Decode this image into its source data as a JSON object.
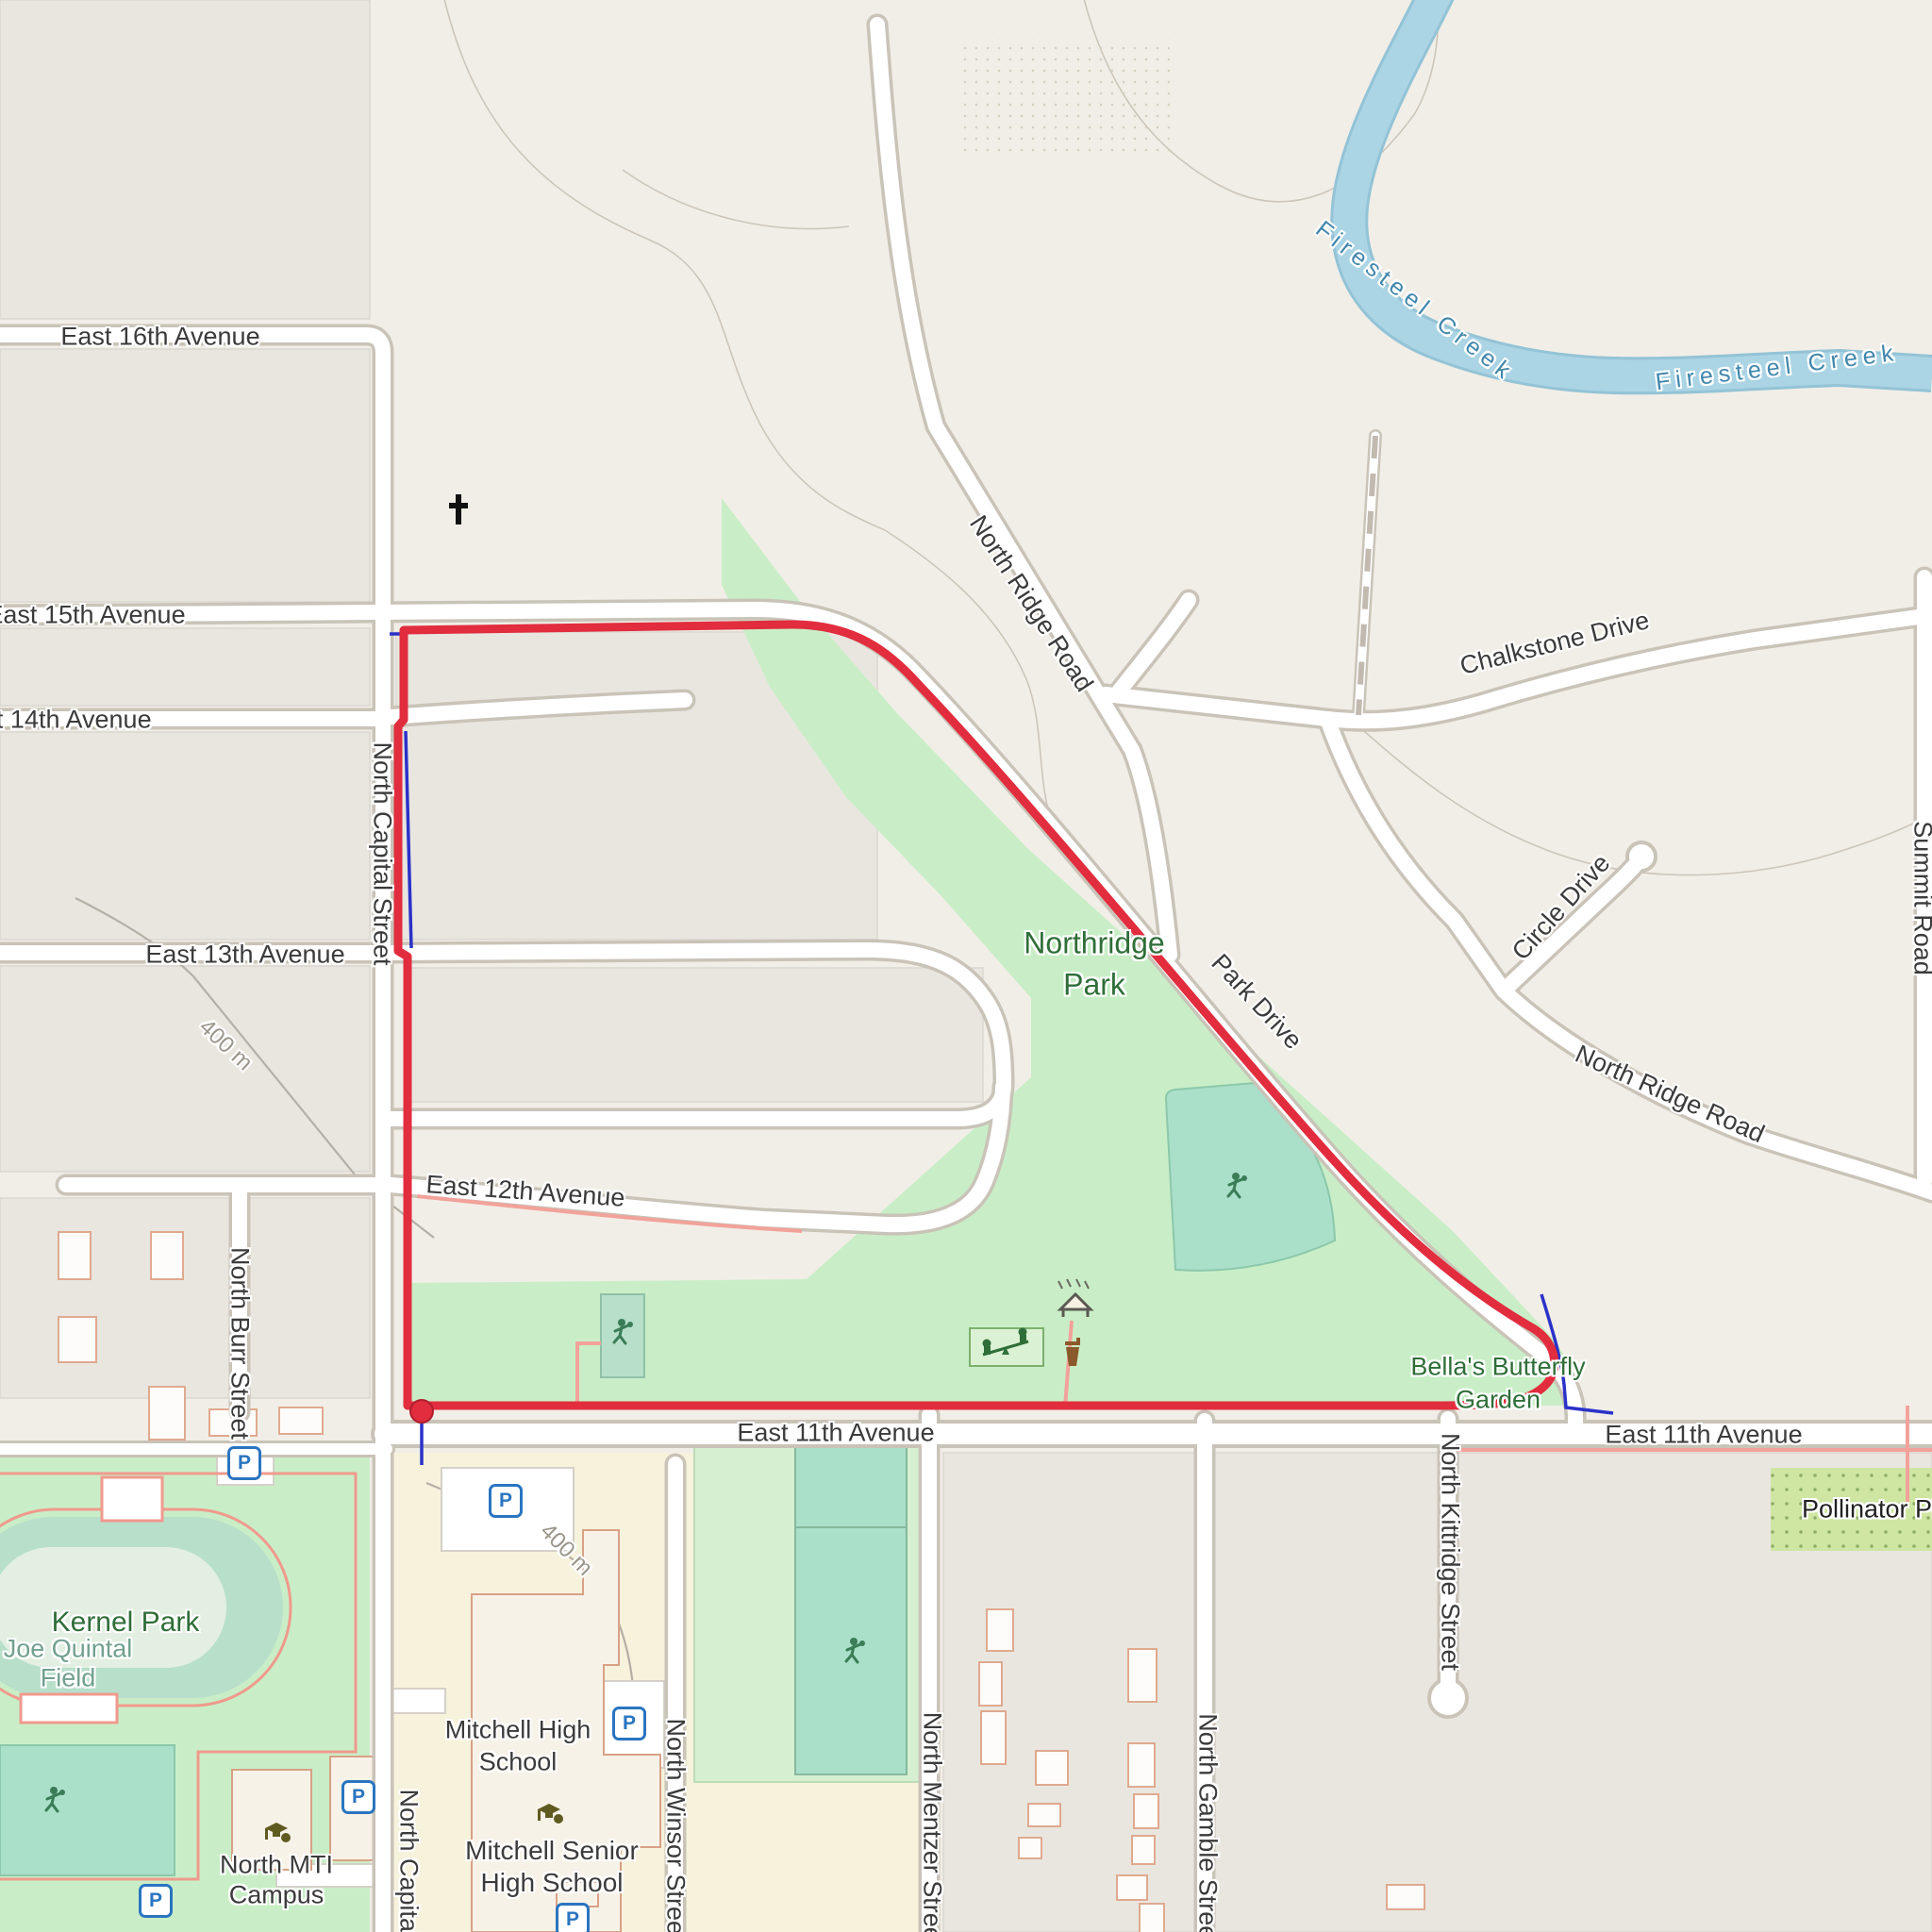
{
  "map": {
    "kind": "route-map",
    "route": {
      "color": "#e12d3e",
      "start_end_marker": "red-dot",
      "planned_color": "#2b32c8"
    },
    "colors": {
      "water": "#abd4e4",
      "park_green": "#c9eec7",
      "pitch_green": "#aadfc9",
      "school_yellow": "#f6f2dc",
      "parking_blue": "#2a75c0",
      "path_pink": "#f2a29a"
    },
    "glyphs": {
      "parking": "P"
    },
    "labels": [
      {
        "id": "e16",
        "text": "East 16th Avenue"
      },
      {
        "id": "e15",
        "text": "East 15th Avenue"
      },
      {
        "id": "e14",
        "text": "East 14th Avenue"
      },
      {
        "id": "e13",
        "text": "East 13th Avenue"
      },
      {
        "id": "e12",
        "text": "East 12th Avenue"
      },
      {
        "id": "e11-center",
        "text": "East 11th Avenue"
      },
      {
        "id": "e11-east",
        "text": "East 11th Avenue"
      },
      {
        "id": "capital",
        "text": "North Capital Street"
      },
      {
        "id": "capital-2",
        "text": "North Capital Street"
      },
      {
        "id": "burr",
        "text": "North Burr Street"
      },
      {
        "id": "winsor",
        "text": "North Winsor Street"
      },
      {
        "id": "mentzer",
        "text": "North Mentzer Street"
      },
      {
        "id": "gamble",
        "text": "North Gamble Street"
      },
      {
        "id": "kittridge",
        "text": "North Kittridge Street"
      },
      {
        "id": "northridge-rd-1",
        "text": "North Ridge Road"
      },
      {
        "id": "northridge-rd-2",
        "text": "North Ridge Road"
      },
      {
        "id": "chalkstone",
        "text": "Chalkstone Drive"
      },
      {
        "id": "circle",
        "text": "Circle Drive"
      },
      {
        "id": "summit",
        "text": "Summit Road"
      },
      {
        "id": "park-drive",
        "text": "Park Drive"
      },
      {
        "id": "northridge-park-1",
        "text": "Northridge"
      },
      {
        "id": "northridge-park-2",
        "text": "Park"
      },
      {
        "id": "bella-1",
        "text": "Bella's Butterfly"
      },
      {
        "id": "bella-2",
        "text": "Garden"
      },
      {
        "id": "creek-1",
        "text": "Firesteel Creek"
      },
      {
        "id": "creek-2",
        "text": "Firesteel Creek"
      },
      {
        "id": "kernel",
        "text": "Kernel Park"
      },
      {
        "id": "quintal-1",
        "text": "Joe Quintal"
      },
      {
        "id": "quintal-2",
        "text": "Field"
      },
      {
        "id": "mhs-1",
        "text": "Mitchell High"
      },
      {
        "id": "mhs-2",
        "text": "School"
      },
      {
        "id": "mshs-1",
        "text": "Mitchell Senior"
      },
      {
        "id": "mshs-2",
        "text": "High School"
      },
      {
        "id": "mti-1",
        "text": "North MTI"
      },
      {
        "id": "mti-2",
        "text": "Campus"
      },
      {
        "id": "pollinator",
        "text": "Pollinator Pl"
      },
      {
        "id": "dist-1",
        "text": "400 m"
      },
      {
        "id": "dist-2",
        "text": "400 m"
      }
    ]
  }
}
